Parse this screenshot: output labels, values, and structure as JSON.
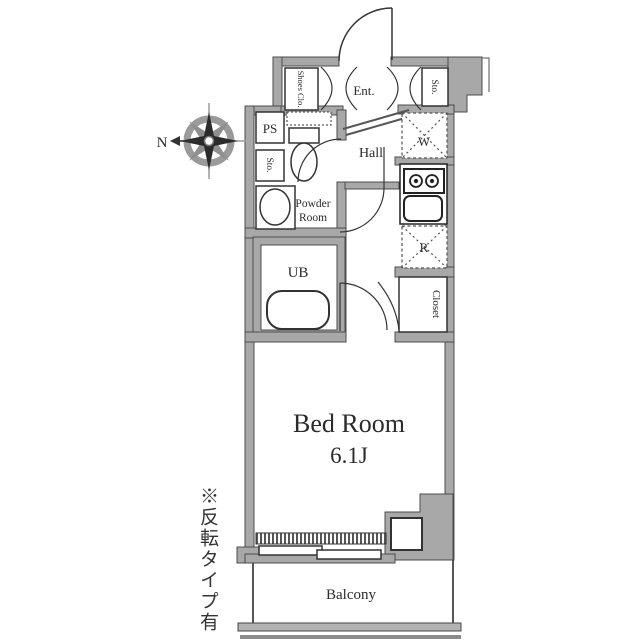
{
  "plan": {
    "compass": {
      "north_label": "N"
    },
    "labels": {
      "shoes_closet": "Shoes Clo.",
      "entrance": "Ent.",
      "storage_top": "Sto.",
      "pipe_space": "PS",
      "storage_left": "Sto.",
      "powder_room_line1": "Powder",
      "powder_room_line2": "Room",
      "hall": "Hall",
      "washer": "W",
      "refrigerator": "R",
      "unit_bath": "UB",
      "closet": "Closet",
      "bedroom_name": "Bed Room",
      "bedroom_size": "6.1J",
      "balcony": "Balcony"
    },
    "note": "※反転タイプ有",
    "colors": {
      "wall_fill": "#a8a8a8",
      "wall_edge": "#4c4c4c",
      "line": "#333333",
      "text": "#2b2b2b",
      "background": "#ffffff"
    }
  }
}
